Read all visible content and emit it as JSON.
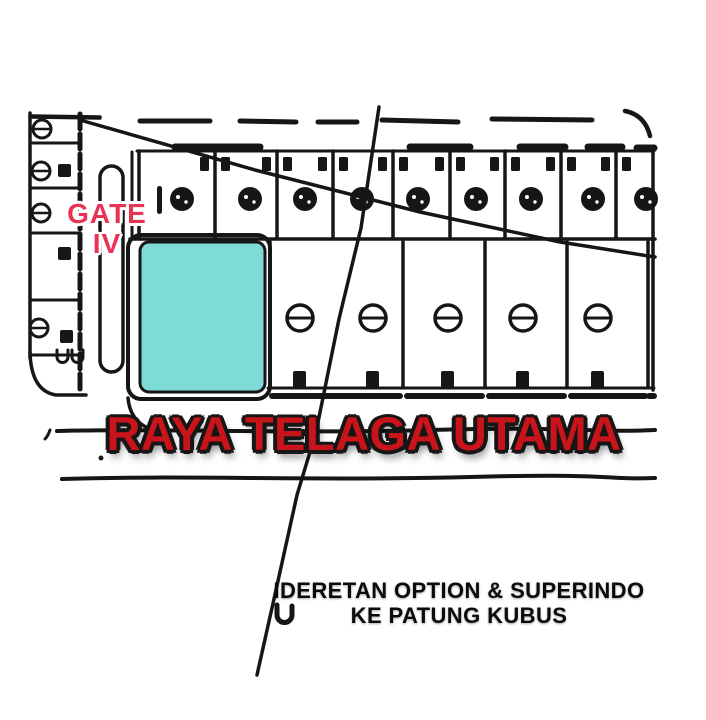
{
  "map": {
    "gate_label": {
      "line1": "GATE",
      "line2": "IV"
    },
    "street_name": "RAYA TELAGA UTAMA",
    "caption": {
      "line1": "IDERETAN OPTION & SUPERINDO",
      "line2": "KE PATUNG KUBUS"
    },
    "highlighted_plot": {
      "description": "cyan highlighted lot beside Gate IV facing Raya Telaga Utama",
      "color": "#7edbd8"
    },
    "lot_rows": {
      "top_row_lot_count": 9,
      "second_row_lot_count": 5,
      "left_column_lot_count": 4
    },
    "symbols": {
      "top_row_symbol": "filled-circle",
      "second_row_symbol": "circle-with-dash",
      "left_column_symbol": "circle-with-dash"
    }
  },
  "colors": {
    "ink": "#161616",
    "paper": "#ffffff",
    "plot_cyan": "#7edbd8",
    "street_red": "#c8141a",
    "gate_red": "#e93354"
  }
}
